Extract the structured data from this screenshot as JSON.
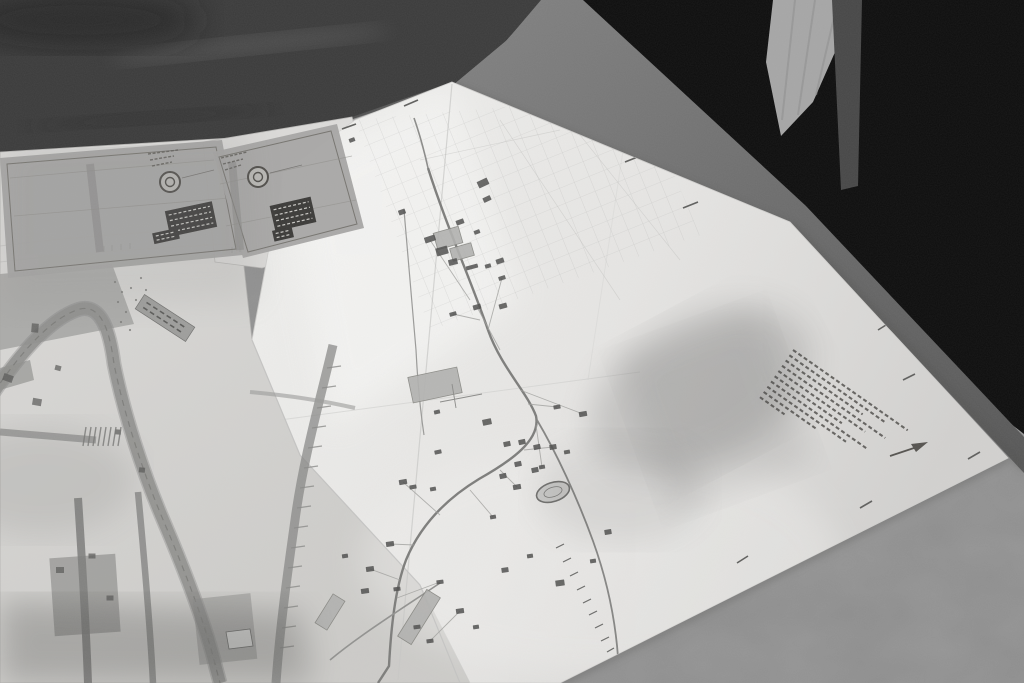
{
  "scene": {
    "description": "Black-and-white photograph: two large folded site plans / maps spread on a table, dark standing figures behind the table, mottled grey tabletop",
    "style": "monochrome-photo"
  },
  "palette": {
    "table_mid": "#8d8d8d",
    "table_dark": "#3b3b3b",
    "figure_black": "#0d0d0d",
    "floor_light": "#a6a6a6",
    "band_gray": "#6e6e6e",
    "paper": "#e7e6e4",
    "paper_under": "#d8d7d5",
    "panel_gray": "#a7a6a4",
    "ink": "#4e4e4c",
    "block_gray": "#b1b1af",
    "label_dark": "#3b3a38"
  },
  "cartouches": [
    {
      "name": "cartouche-left",
      "polygon": "0,158 222,140 243,255 8,278",
      "inset": "7,164 216,147 236,249 15,271",
      "logo": {
        "cx": 170,
        "cy": 182,
        "r": 10
      },
      "label_box": {
        "cx": 191,
        "cy": 219,
        "w": 48,
        "h": 26,
        "rot": -12,
        "rows": 4
      },
      "small_box": {
        "cx": 166,
        "cy": 236,
        "w": 26,
        "h": 11,
        "rot": -12,
        "rows": 2
      },
      "header_dashes": [
        [
          148,
          154,
          178,
          150
        ],
        [
          150,
          160,
          174,
          156
        ],
        [
          152,
          166,
          172,
          162
        ]
      ],
      "stripe": [
        90,
        164,
        100,
        252
      ],
      "rules": [
        [
          10,
          178,
          214,
          160
        ],
        [
          14,
          216,
          230,
          198
        ]
      ]
    },
    {
      "name": "cartouche-right",
      "polygon": "213,152 337,124 364,228 243,258",
      "inset": "219,157 331,131 357,224 248,252",
      "logo": {
        "cx": 258,
        "cy": 177,
        "r": 10
      },
      "label_box": {
        "cx": 293,
        "cy": 214,
        "w": 42,
        "h": 26,
        "rot": -13,
        "rows": 4
      },
      "small_box": {
        "cx": 283,
        "cy": 234,
        "w": 20,
        "h": 11,
        "rot": -13,
        "rows": 2
      },
      "header_dashes": [
        [
          221,
          158,
          247,
          152
        ],
        [
          223,
          164,
          243,
          159
        ],
        [
          225,
          170,
          241,
          165
        ]
      ],
      "stripe": [
        232,
        162,
        240,
        250
      ],
      "rules": [
        [
          220,
          184,
          352,
          156
        ],
        [
          226,
          226,
          356,
          200
        ]
      ]
    }
  ],
  "main_map": {
    "dark_buildings": [
      [
        483,
        183,
        11,
        7,
        -25
      ],
      [
        487,
        199,
        8,
        5,
        -25
      ],
      [
        402,
        212,
        7,
        5,
        -20
      ],
      [
        460,
        222,
        8,
        5,
        -20
      ],
      [
        477,
        232,
        6,
        4,
        -20
      ],
      [
        430,
        239,
        11,
        6,
        -18
      ],
      [
        453,
        262,
        9,
        6,
        -15
      ],
      [
        472,
        267,
        12,
        4,
        -15
      ],
      [
        488,
        266,
        6,
        4,
        -15
      ],
      [
        500,
        261,
        8,
        5,
        -18
      ],
      [
        502,
        278,
        7,
        4,
        -18
      ],
      [
        453,
        314,
        7,
        4,
        -15
      ],
      [
        477,
        307,
        8,
        5,
        -15
      ],
      [
        503,
        306,
        8,
        5,
        -15
      ],
      [
        557,
        407,
        7,
        4,
        -10
      ],
      [
        583,
        414,
        8,
        5,
        -10
      ],
      [
        437,
        412,
        6,
        4,
        -12
      ],
      [
        487,
        422,
        9,
        6,
        -12
      ],
      [
        438,
        452,
        7,
        4,
        -12
      ],
      [
        403,
        482,
        8,
        5,
        -10
      ],
      [
        413,
        487,
        7,
        4,
        -10
      ],
      [
        433,
        489,
        6,
        4,
        -10
      ],
      [
        493,
        517,
        6,
        4,
        -10
      ],
      [
        517,
        487,
        8,
        5,
        -10
      ],
      [
        542,
        467,
        6,
        4,
        -10
      ],
      [
        553,
        447,
        7,
        5,
        -10
      ],
      [
        567,
        452,
        6,
        4,
        -10
      ],
      [
        507,
        444,
        7,
        5,
        -12
      ],
      [
        522,
        442,
        7,
        5,
        -12
      ],
      [
        537,
        447,
        7,
        5,
        -12
      ],
      [
        518,
        464,
        7,
        5,
        -12
      ],
      [
        503,
        476,
        7,
        5,
        -12
      ],
      [
        535,
        470,
        7,
        5,
        -12
      ],
      [
        608,
        532,
        7,
        5,
        -10
      ],
      [
        390,
        544,
        8,
        5,
        -8
      ],
      [
        370,
        569,
        8,
        5,
        -8
      ],
      [
        365,
        591,
        8,
        5,
        -8
      ],
      [
        397,
        589,
        7,
        4,
        -8
      ],
      [
        440,
        582,
        7,
        4,
        -8
      ],
      [
        460,
        611,
        8,
        5,
        -8
      ],
      [
        417,
        627,
        7,
        4,
        -8
      ],
      [
        430,
        641,
        7,
        4,
        -8
      ],
      [
        476,
        627,
        6,
        4,
        -8
      ],
      [
        505,
        570,
        7,
        5,
        -8
      ],
      [
        530,
        556,
        6,
        4,
        -8
      ],
      [
        560,
        583,
        9,
        6,
        -8
      ],
      [
        352,
        140,
        6,
        4,
        -20
      ],
      [
        442,
        251,
        12,
        8,
        -16
      ],
      [
        345,
        556,
        6,
        4,
        -8
      ],
      [
        593,
        561,
        6,
        4,
        -8
      ]
    ],
    "gray_buildings": [
      [
        448,
        238,
        26,
        17,
        -16
      ],
      [
        462,
        252,
        22,
        13,
        -16
      ],
      [
        435,
        385,
        50,
        26,
        -12
      ],
      [
        419,
        617,
        55,
        16,
        -58
      ],
      [
        330,
        612,
        34,
        14,
        -58
      ]
    ],
    "stadium": {
      "cx": 553,
      "cy": 492,
      "rx": 17,
      "ry": 9.5,
      "rot": -18
    },
    "edge_ticks": [
      [
        520,
        88,
        533,
        82
      ],
      [
        625,
        162,
        640,
        156
      ],
      [
        683,
        208,
        698,
        202
      ],
      [
        860,
        508,
        872,
        501
      ],
      [
        737,
        563,
        748,
        556
      ],
      [
        968,
        459,
        980,
        452
      ],
      [
        903,
        380,
        915,
        374
      ],
      [
        418,
        100,
        404,
        106
      ],
      [
        356,
        124,
        342,
        129
      ],
      [
        878,
        330,
        886,
        325
      ]
    ],
    "railway_ticks": [
      [
        556,
        548,
        564,
        544
      ],
      [
        563,
        562,
        571,
        558
      ],
      [
        570,
        576,
        578,
        572
      ],
      [
        577,
        590,
        585,
        586
      ],
      [
        583,
        603,
        591,
        599
      ],
      [
        589,
        615,
        597,
        611
      ],
      [
        595,
        628,
        603,
        624
      ],
      [
        601,
        641,
        609,
        637
      ],
      [
        607,
        652,
        614,
        648
      ]
    ],
    "annotation_block": {
      "x": 793,
      "y": 350,
      "angle": 35,
      "gap": 6.4,
      "widths": [
        140,
        116,
        94,
        126,
        106,
        82,
        118,
        96,
        64,
        30
      ]
    },
    "north_arrow": {
      "x1": 890,
      "y1": 456,
      "x2": 920,
      "y2": 446,
      "head": "928,442 911,444 916,452"
    }
  },
  "left_map": {
    "dark_bits": [
      [
        8,
        378,
        10,
        7,
        20
      ],
      [
        35,
        328,
        7,
        9,
        5
      ],
      [
        37,
        402,
        9,
        7,
        10
      ],
      [
        58,
        368,
        6,
        5,
        15
      ],
      [
        118,
        432,
        6,
        5,
        5
      ],
      [
        142,
        470,
        6,
        5,
        5
      ],
      [
        60,
        570,
        8,
        6,
        0
      ],
      [
        92,
        556,
        7,
        5,
        0
      ],
      [
        110,
        598,
        7,
        5,
        0
      ]
    ],
    "hatch_xs": [
      86,
      91,
      96,
      101,
      106,
      111,
      116,
      121
    ],
    "rungs": [
      [
        327,
        368,
        341,
        366
      ],
      [
        322,
        388,
        336,
        386
      ],
      [
        317,
        408,
        331,
        406
      ],
      [
        312,
        428,
        326,
        426
      ],
      [
        308,
        448,
        322,
        446
      ],
      [
        304,
        468,
        318,
        466
      ],
      [
        300,
        488,
        314,
        486
      ],
      [
        297,
        508,
        311,
        506
      ],
      [
        294,
        528,
        308,
        526
      ],
      [
        291,
        548,
        305,
        546
      ],
      [
        288,
        568,
        302,
        566
      ],
      [
        286,
        588,
        300,
        586
      ],
      [
        284,
        608,
        298,
        606
      ],
      [
        282,
        628,
        296,
        626
      ],
      [
        280,
        648,
        294,
        646
      ]
    ],
    "dots": [
      [
        115,
        282
      ],
      [
        122,
        292
      ],
      [
        118,
        302
      ],
      [
        126,
        312
      ],
      [
        121,
        322
      ],
      [
        130,
        330
      ],
      [
        136,
        300
      ],
      [
        131,
        288
      ],
      [
        141,
        278
      ],
      [
        146,
        290
      ]
    ],
    "label_box": {
      "cx": 165,
      "cy": 318,
      "w": 60,
      "h": 17,
      "rot": 33,
      "rows": 2
    }
  },
  "sheet_marks": [
    [
      104,
      246
    ],
    [
      112,
      245
    ],
    [
      121,
      244
    ],
    [
      130,
      243
    ],
    [
      232,
      247
    ],
    [
      240,
      246
    ]
  ]
}
